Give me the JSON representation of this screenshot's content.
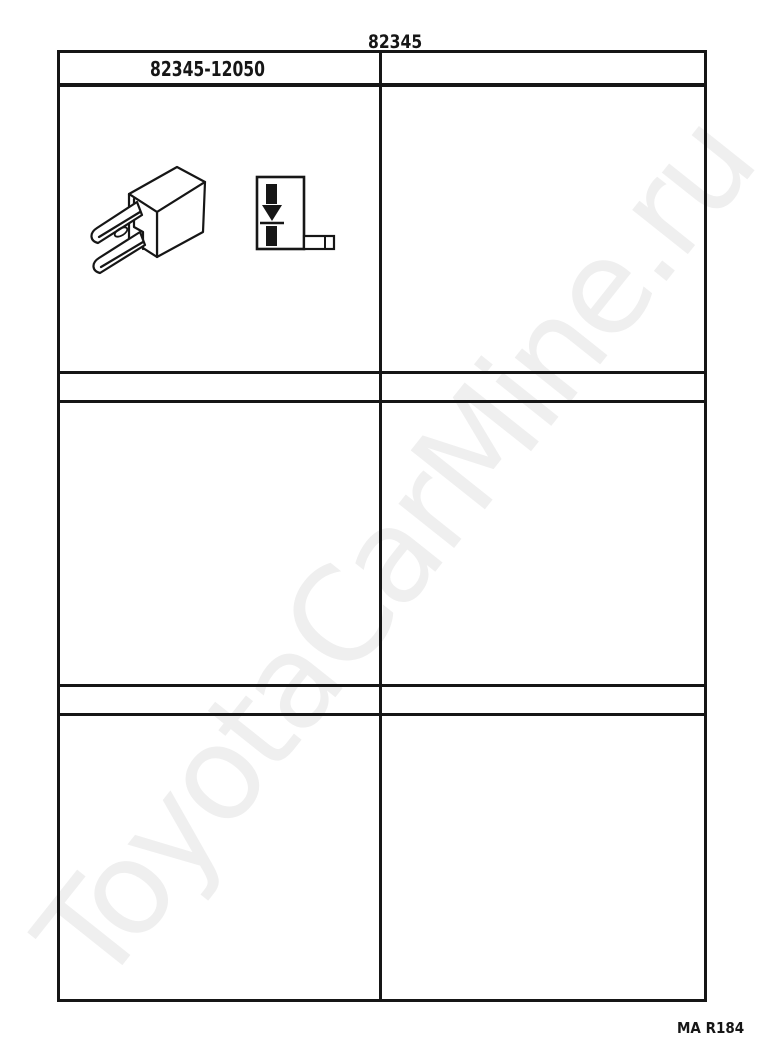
{
  "page": {
    "title": "82345",
    "footer_code": "MA R184",
    "watermark": "ToyotaCarMine.ru"
  },
  "catalog_table": {
    "columns": 2,
    "rows": 3,
    "header": {
      "part_number": "82345-12050"
    }
  },
  "icons": {
    "part_drawing": "relay-diode-part-drawing",
    "circuit_symbol": "diode-circuit-symbol"
  },
  "colors": {
    "background": "#ffffff",
    "line": "#161616",
    "text": "#161616",
    "watermark": "#efefef"
  }
}
